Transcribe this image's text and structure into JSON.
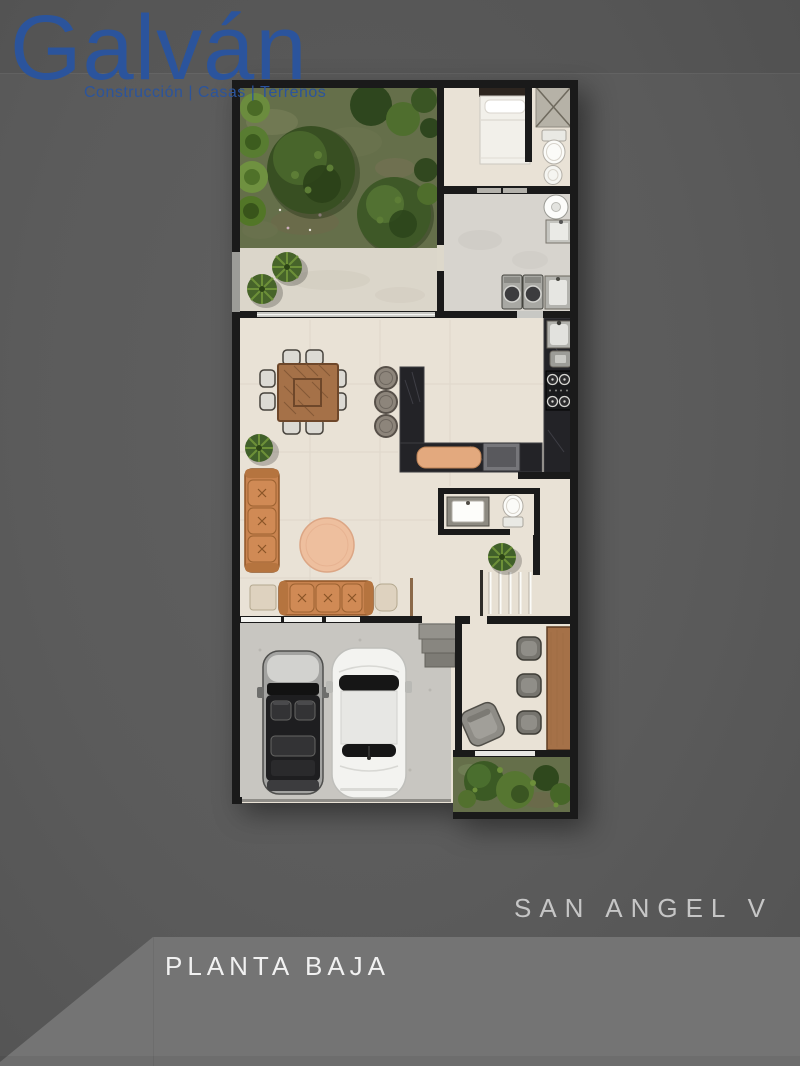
{
  "brand": {
    "name": "Galván",
    "tagline": "Construcción | Casas | Terrenos"
  },
  "titles": {
    "project": "SAN ANGEL V",
    "floor": "PLANTA BAJA"
  },
  "colors": {
    "bg_dark": "#5b5b5b",
    "bg_light": "#747474",
    "logo_blue": "#2b549c",
    "project_text": "#c6c6c6",
    "floor_text": "#f1f1f1",
    "wall": "#1a1a1a",
    "floor_beige": "#e9e2d6",
    "floor_gray": "#d7d4ce",
    "terrace": "#dbd6ca",
    "garage": "#c8c6c1",
    "counter": "#232327",
    "sofa": "#c8834f",
    "wood": "#a57148",
    "rug": "#eebf9e",
    "garden": "#656f4a",
    "bush_dark": "#3a5323",
    "bush_light": "#6f9140"
  }
}
